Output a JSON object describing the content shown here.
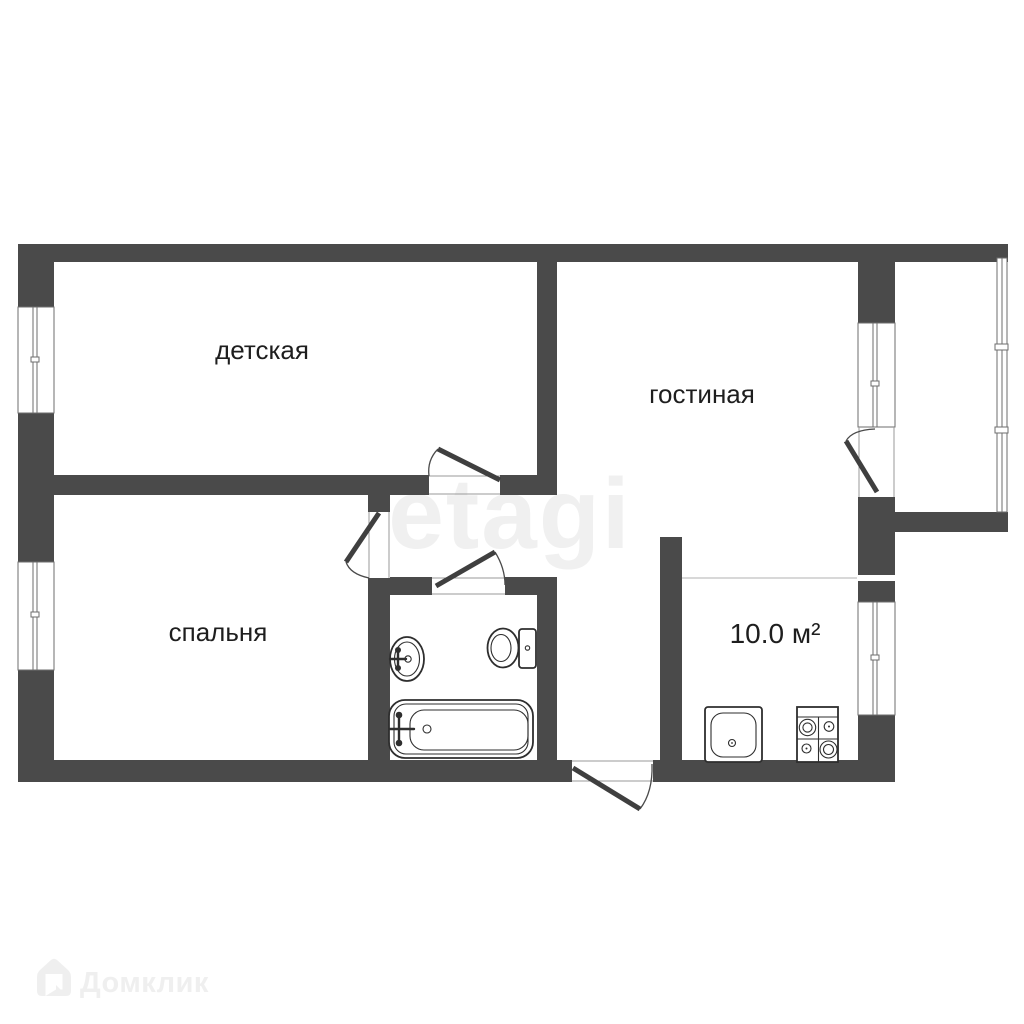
{
  "plan": {
    "type": "apartment-floor-plan",
    "background": "#ffffff",
    "wall_color": "#4a4a4a",
    "door_leaf_color": "#3f3f3f",
    "thin_line_color": "#6e6e6e",
    "label_color": "#1e1e1e",
    "rooms": [
      {
        "id": "children-room",
        "label": "детская"
      },
      {
        "id": "living-room",
        "label": "гостиная"
      },
      {
        "id": "bedroom",
        "label": "спальня"
      },
      {
        "id": "kitchen",
        "label": "10.0 м²"
      }
    ],
    "fixtures": [
      "bathroom-sink",
      "toilet",
      "bathtub",
      "kitchen-sink",
      "stove"
    ],
    "windows_count": 5,
    "doors_count": 5,
    "watermarks": {
      "center": {
        "text": "etagi",
        "color": "#f0f0f0"
      },
      "bottom_left": {
        "text": "Домклик",
        "color": "#efefef"
      }
    }
  }
}
